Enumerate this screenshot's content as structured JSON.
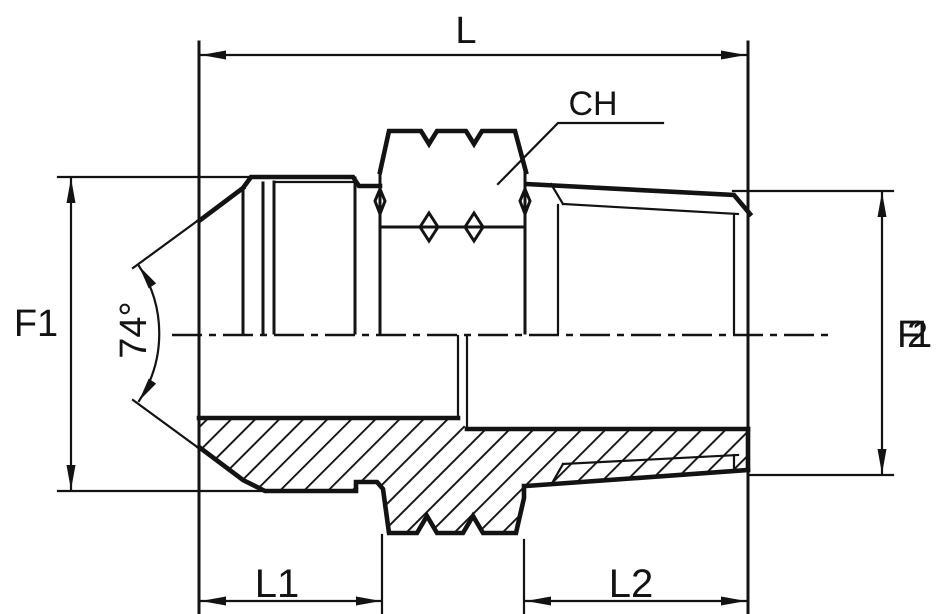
{
  "labels": {
    "length_overall": "L",
    "wrench_size": "CH",
    "flare_end_diameter": "F1",
    "flare_angle": "74°",
    "thread_end_prefix": "F",
    "thread_end_digit_a": "1",
    "thread_end_digit_b": "2",
    "length_flare_end": "L1",
    "length_thread_end": "L2"
  },
  "colors": {
    "ink": "#131313",
    "background": "#ffffff"
  }
}
